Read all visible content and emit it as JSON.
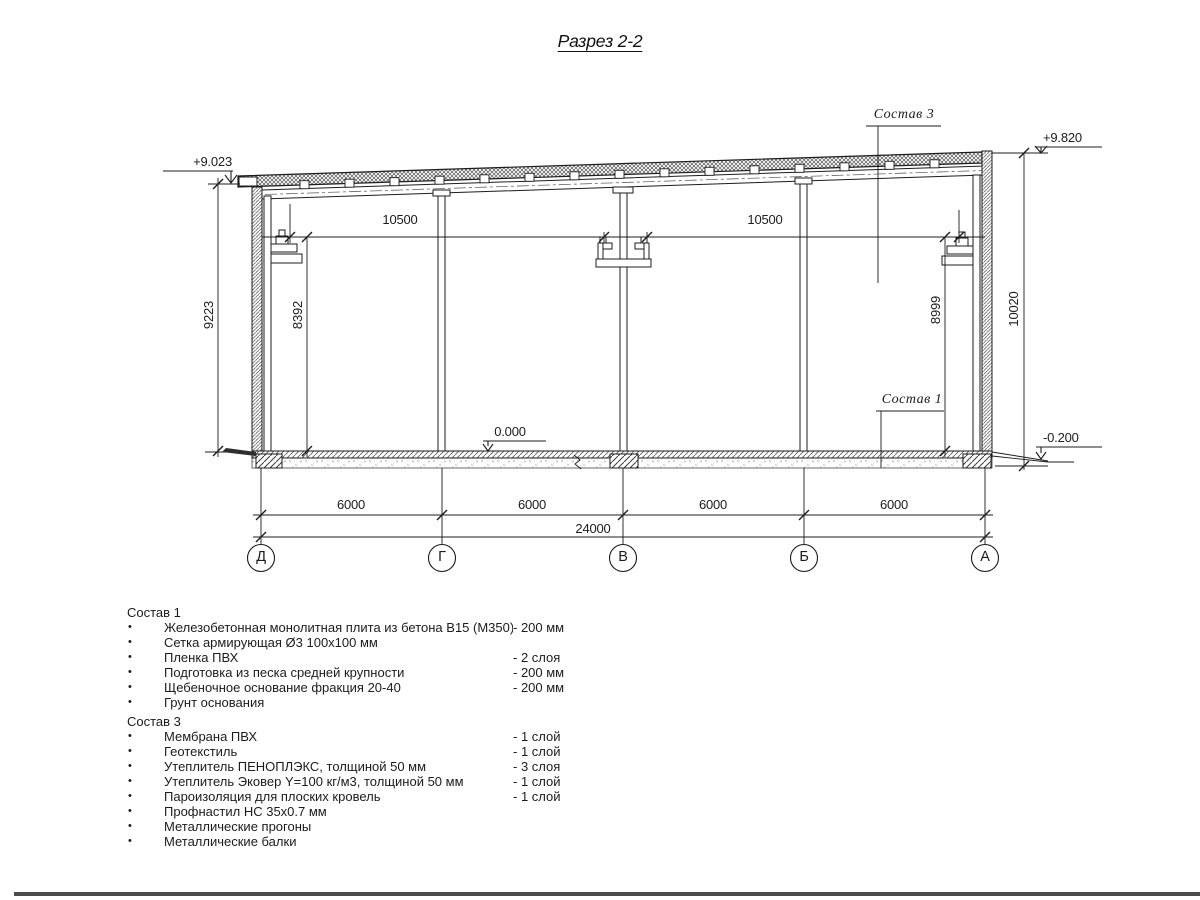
{
  "page": {
    "title": "Разрез 2-2"
  },
  "drawing": {
    "elevations": {
      "left_top": "+9.023",
      "right_top": "+9.820",
      "floor": "0.000",
      "right_bottom": "-0.200"
    },
    "callouts": {
      "roof": "Состав 3",
      "floor": "Состав 1"
    },
    "dimensions": {
      "crane_span_left": "10500",
      "crane_span_right": "10500",
      "height_left_outer": "9223",
      "height_left_inner": "8392",
      "height_right_inner": "8999",
      "height_right_outer": "10020",
      "bays": [
        "6000",
        "6000",
        "6000",
        "6000"
      ],
      "total": "24000"
    },
    "axes": [
      "Д",
      "Г",
      "В",
      "Б",
      "А"
    ]
  },
  "materials": [
    {
      "title": "Состав 1",
      "items": [
        {
          "name": "Железобетонная монолитная плита из бетона В15 (М350)",
          "value": "-  200 мм"
        },
        {
          "name": "Сетка армирующая Ø3 100х100 мм",
          "value": ""
        },
        {
          "name": "Пленка ПВХ",
          "value": "-  2 слоя"
        },
        {
          "name": "Подготовка из песка средней крупности",
          "value": "- 200 мм"
        },
        {
          "name": "Щебеночное основание фракция 20-40",
          "value": "- 200 мм"
        },
        {
          "name": "Грунт основания",
          "value": ""
        }
      ]
    },
    {
      "title": "Состав 3",
      "items": [
        {
          "name": "Мембрана ПВХ",
          "value": "- 1 слой"
        },
        {
          "name": "Геотекстиль",
          "value": "- 1 слой"
        },
        {
          "name": "Утеплитель ПЕНОПЛЭКС, толщиной 50 мм",
          "value": "- 3 слоя"
        },
        {
          "name": "Утеплитель Эковер Y=100 кг/м3, толщиной 50 мм",
          "value": "- 1 слой"
        },
        {
          "name": "Пароизоляция для плоских кровель",
          "value": "- 1 слой"
        },
        {
          "name": "Профнастил НС 35х0.7 мм",
          "value": ""
        },
        {
          "name": "Металлические прогоны",
          "value": ""
        },
        {
          "name": "Металлические балки",
          "value": ""
        }
      ]
    }
  ]
}
